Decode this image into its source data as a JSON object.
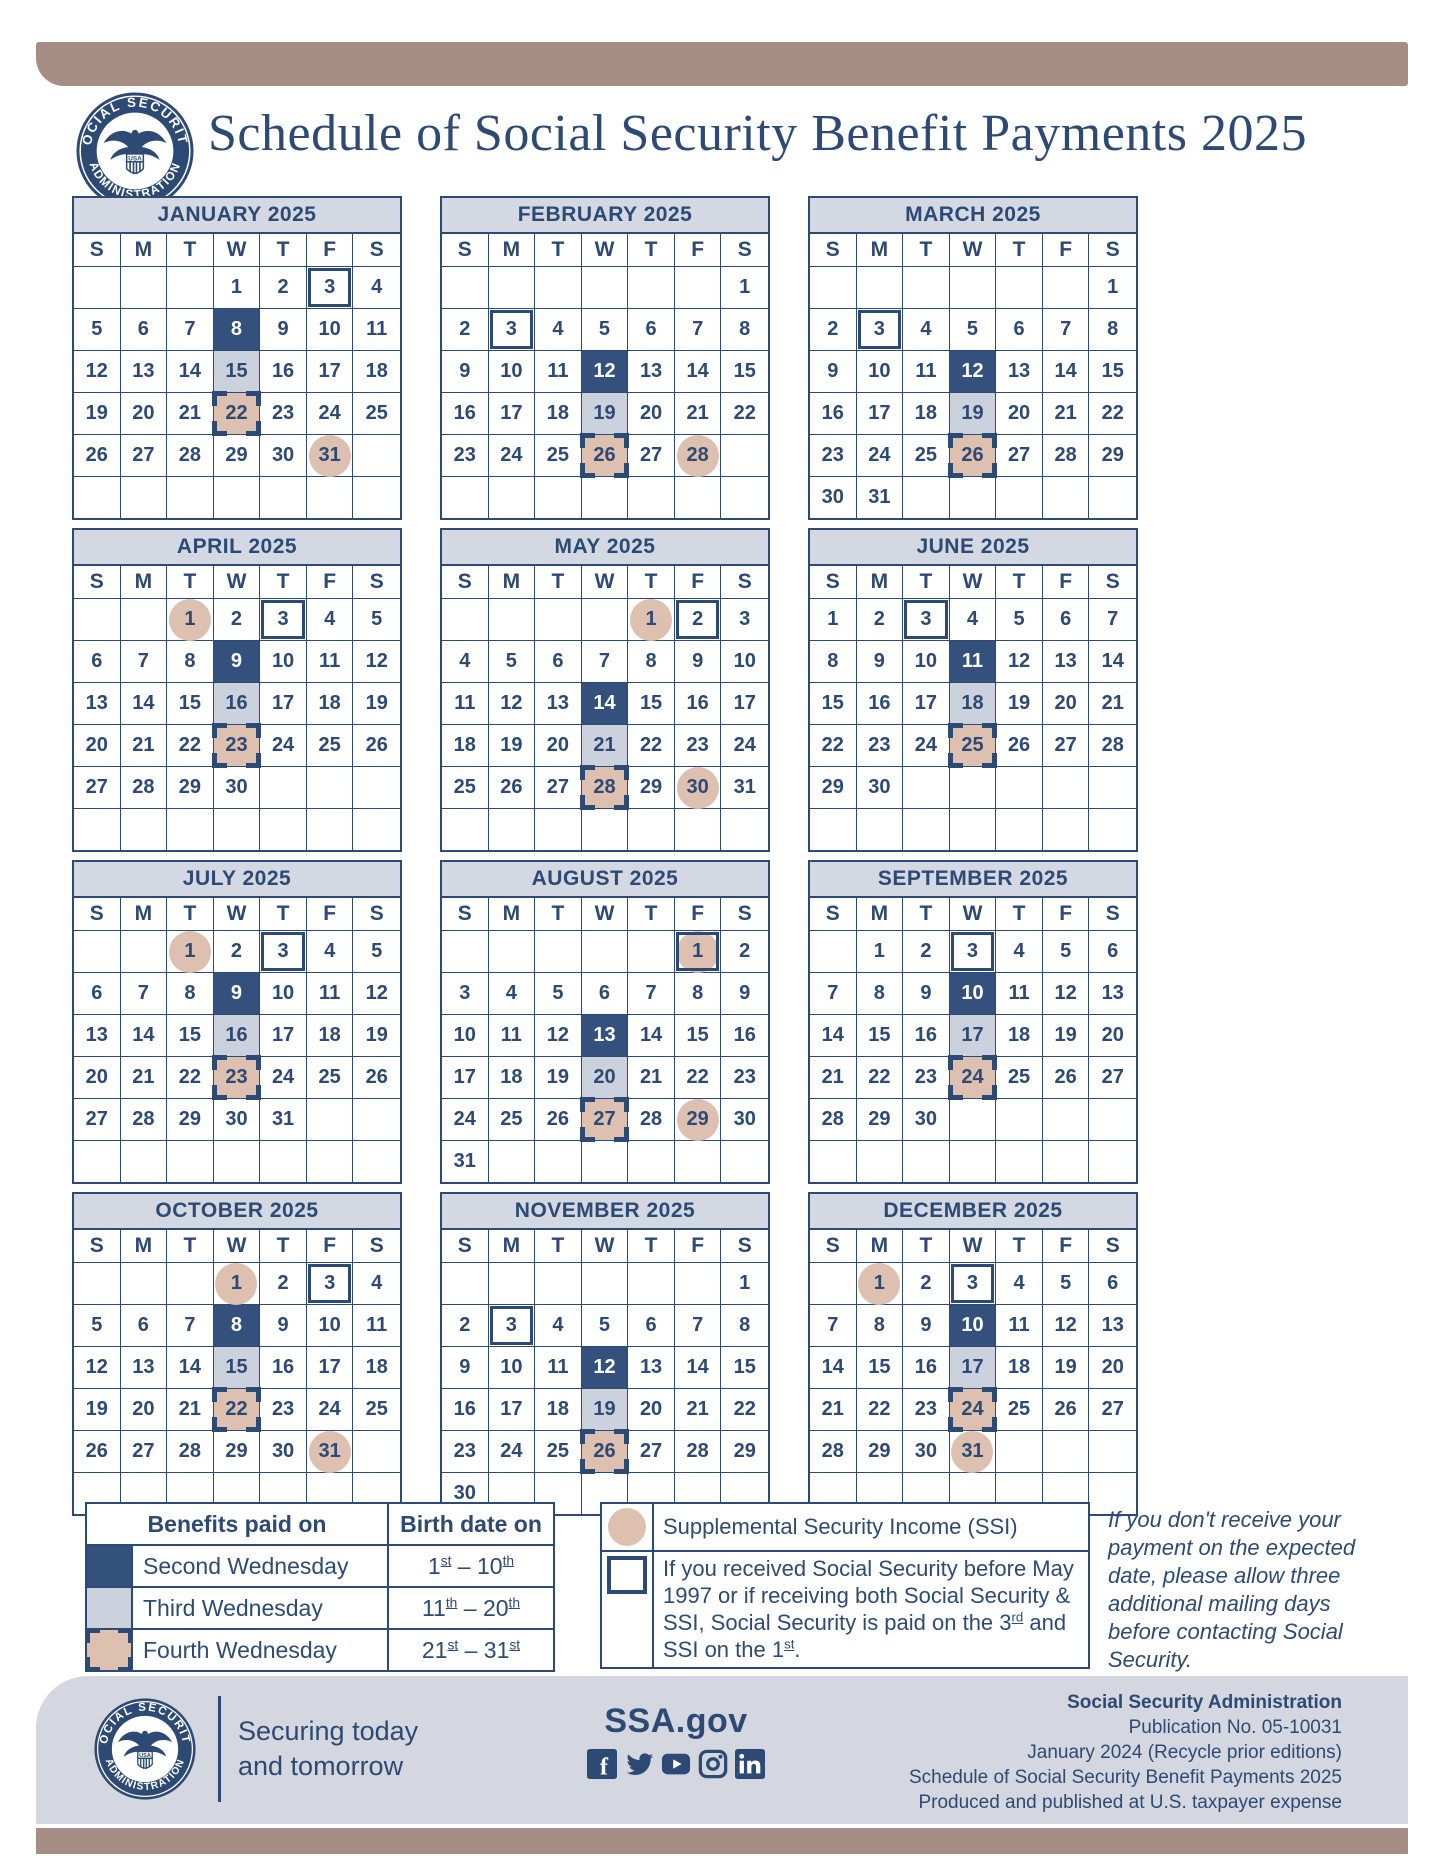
{
  "header": {
    "title": "Schedule of Social Security Benefit Payments 2025",
    "seal": {
      "top": "SOCIAL SECURITY",
      "bottom": "ADMINISTRATION",
      "shield": "USA"
    }
  },
  "colors": {
    "navy": "#2c4a74",
    "second_wednesday_fill": "#34517d",
    "third_wednesday_fill": "#cbd2dd",
    "fourth_wednesday_fill": "#ddc0b0",
    "ssi_circle_fill": "#ddc0b0",
    "accent_bar": "#a68e85",
    "month_header_bg": "#d3d8e2",
    "footer_bg": "#d4d7df"
  },
  "calendar": {
    "day_headers": [
      "S",
      "M",
      "T",
      "W",
      "T",
      "F",
      "S"
    ],
    "months": [
      {
        "name": "JANUARY 2025",
        "offset": 3,
        "days": 31,
        "second_wed": 8,
        "third_wed": 15,
        "fourth_wed": 22,
        "pre1997_box": [
          3
        ],
        "ssi_circle": [
          31
        ]
      },
      {
        "name": "FEBRUARY 2025",
        "offset": 6,
        "days": 28,
        "second_wed": 12,
        "third_wed": 19,
        "fourth_wed": 26,
        "pre1997_box": [
          3
        ],
        "ssi_circle": [
          28
        ]
      },
      {
        "name": "MARCH 2025",
        "offset": 6,
        "days": 31,
        "second_wed": 12,
        "third_wed": 19,
        "fourth_wed": 26,
        "pre1997_box": [
          3
        ],
        "ssi_circle": []
      },
      {
        "name": "APRIL 2025",
        "offset": 2,
        "days": 30,
        "second_wed": 9,
        "third_wed": 16,
        "fourth_wed": 23,
        "pre1997_box": [
          3
        ],
        "ssi_circle": [
          1
        ]
      },
      {
        "name": "MAY 2025",
        "offset": 4,
        "days": 31,
        "second_wed": 14,
        "third_wed": 21,
        "fourth_wed": 28,
        "pre1997_box": [
          2
        ],
        "ssi_circle": [
          1,
          30
        ]
      },
      {
        "name": "JUNE 2025",
        "offset": 0,
        "days": 30,
        "second_wed": 11,
        "third_wed": 18,
        "fourth_wed": 25,
        "pre1997_box": [
          3
        ],
        "ssi_circle": []
      },
      {
        "name": "JULY 2025",
        "offset": 2,
        "days": 31,
        "second_wed": 9,
        "third_wed": 16,
        "fourth_wed": 23,
        "pre1997_box": [
          3
        ],
        "ssi_circle": [
          1
        ]
      },
      {
        "name": "AUGUST 2025",
        "offset": 5,
        "days": 31,
        "second_wed": 13,
        "third_wed": 20,
        "fourth_wed": 27,
        "pre1997_box": [
          1
        ],
        "ssi_circle": [
          1,
          29
        ]
      },
      {
        "name": "SEPTEMBER 2025",
        "offset": 1,
        "days": 30,
        "second_wed": 10,
        "third_wed": 17,
        "fourth_wed": 24,
        "pre1997_box": [
          3
        ],
        "ssi_circle": []
      },
      {
        "name": "OCTOBER 2025",
        "offset": 3,
        "days": 31,
        "second_wed": 8,
        "third_wed": 15,
        "fourth_wed": 22,
        "pre1997_box": [
          3
        ],
        "ssi_circle": [
          1,
          31
        ]
      },
      {
        "name": "NOVEMBER 2025",
        "offset": 6,
        "days": 30,
        "second_wed": 12,
        "third_wed": 19,
        "fourth_wed": 26,
        "pre1997_box": [
          3
        ],
        "ssi_circle": []
      },
      {
        "name": "DECEMBER 2025",
        "offset": 1,
        "days": 31,
        "second_wed": 10,
        "third_wed": 17,
        "fourth_wed": 24,
        "pre1997_box": [
          3
        ],
        "ssi_circle": [
          1,
          31
        ]
      }
    ]
  },
  "legend": {
    "paid_table": {
      "header_paid": "Benefits paid on",
      "header_birth": "Birth date on",
      "dash": "–",
      "rows": [
        {
          "swatch": "dark",
          "label": "Second Wednesday",
          "from": "1",
          "from_sup": "st",
          "to": "10",
          "to_sup": "th"
        },
        {
          "swatch": "gray",
          "label": "Third Wednesday",
          "from": "11",
          "from_sup": "th",
          "to": "20",
          "to_sup": "th"
        },
        {
          "swatch": "corners",
          "label": "Fourth Wednesday",
          "from": "21",
          "from_sup": "st",
          "to": "31",
          "to_sup": "st"
        }
      ]
    },
    "ssi": {
      "label": "Supplemental Security Income (SSI)"
    },
    "pre1997": {
      "part1": "If you received Social Security before May 1997 or if receiving both Social Security & SSI, Social Security is paid on the 3",
      "sup1": "rd",
      "part2": " and SSI on the 1",
      "sup2": "st",
      "part3": "."
    },
    "note": "If you don't receive your payment on the expected date, please allow three additional mailing days before contacting Social Security."
  },
  "footer": {
    "tagline_line1": "Securing today",
    "tagline_line2": "and tomorrow",
    "website": "SSA.gov",
    "social_icons": [
      "facebook",
      "twitter",
      "youtube",
      "instagram",
      "linkedin"
    ],
    "publication": {
      "line1": "Social Security Administration",
      "line2": "Publication No. 05-10031",
      "line3": "January 2024 (Recycle prior editions)",
      "line4": "Schedule of Social Security Benefit Payments 2025",
      "line5": "Produced and published at U.S. taxpayer expense"
    }
  }
}
